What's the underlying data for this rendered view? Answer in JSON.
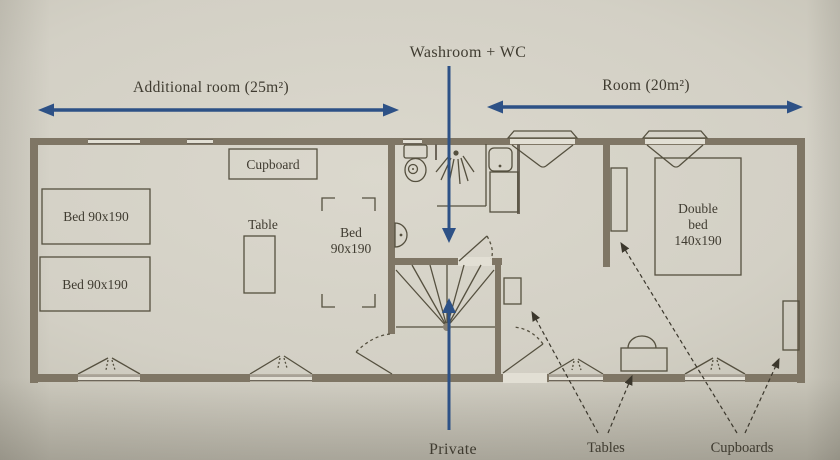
{
  "photo": {
    "colors": {
      "paper": "#d3d0c5",
      "wall": "#7f7665",
      "fixture_line": "#55503f",
      "ink": "#3f3b30",
      "arrow_blue": "#2d5186"
    }
  },
  "annotations": {
    "washroom_label": "Washroom + WC",
    "additional_room_label": "Additional room (25m²)",
    "room_label": "Room (20m²)",
    "private_label": "Private",
    "tables_label": "Tables",
    "cupboards_label": "Cupboards"
  },
  "furniture": {
    "cupboard_box": "Cupboard",
    "bed_left_top": "Bed 90x190",
    "bed_left_bottom": "Bed 90x190",
    "table_left": "Table",
    "bed_center": {
      "l1": "Bed",
      "l2": "90x190"
    },
    "double_bed": {
      "l1": "Double",
      "l2": "bed",
      "l3": "140x190"
    }
  }
}
